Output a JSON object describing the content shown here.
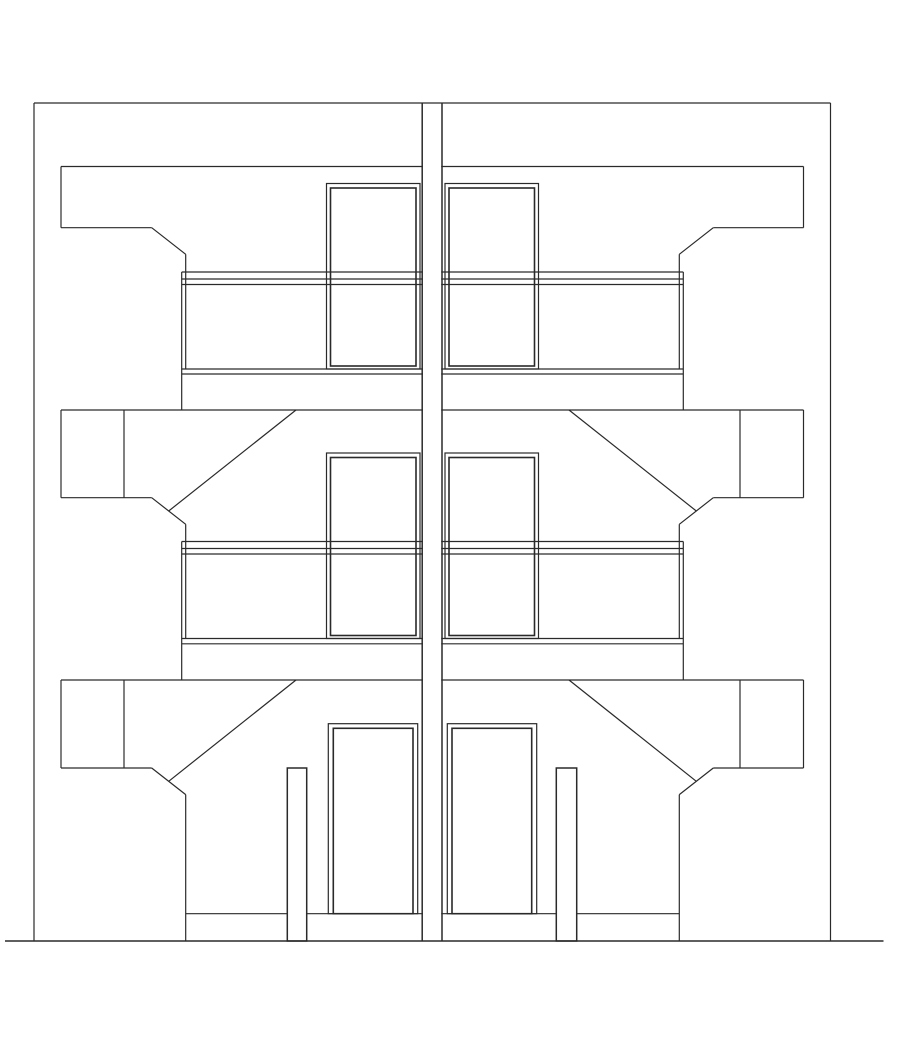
{
  "meta": {
    "canvas": {
      "width": 905,
      "height": 1047
    },
    "background_color": "#ffffff",
    "line_color": "#2a2a2a",
    "default_stroke_width": 1.2
  },
  "drawing": {
    "kind": "building-elevation-line-drawing",
    "layers": [
      {
        "name": "slabs",
        "primitives": [
          {
            "t": "l",
            "n": "roof-slab-top",
            "x1": 61,
            "y1": 166.5,
            "x2": 803.5,
            "y2": 166.5
          },
          {
            "t": "l",
            "n": "roof-slab-left-edge",
            "x1": 61,
            "y1": 166.5,
            "x2": 61,
            "y2": 227.7
          },
          {
            "t": "l",
            "n": "roof-slab-right-edge",
            "x1": 803.5,
            "y1": 166.5,
            "x2": 803.5,
            "y2": 227.7
          },
          {
            "t": "l",
            "n": "roof-slab-bottom-left",
            "x1": 61,
            "y1": 227.7,
            "x2": 151.7,
            "y2": 227.7
          },
          {
            "t": "l",
            "n": "roof-slab-bottom-right",
            "x1": 713.3,
            "y1": 227.7,
            "x2": 803.5,
            "y2": 227.7
          },
          {
            "t": "l",
            "n": "roof-slab-chamfer-left",
            "x1": 151.7,
            "y1": 227.7,
            "x2": 185.7,
            "y2": 254.3
          },
          {
            "t": "l",
            "n": "roof-slab-chamfer-right",
            "x1": 713.3,
            "y1": 227.7,
            "x2": 679.3,
            "y2": 254.3
          },
          {
            "t": "l",
            "n": "mid-slab-top",
            "x1": 61,
            "y1": 410,
            "x2": 803.5,
            "y2": 410
          },
          {
            "t": "l",
            "n": "mid-slab-left-edge",
            "x1": 61,
            "y1": 410,
            "x2": 61,
            "y2": 497.7
          },
          {
            "t": "l",
            "n": "mid-slab-right-edge",
            "x1": 803.5,
            "y1": 410,
            "x2": 803.5,
            "y2": 497.7
          },
          {
            "t": "l",
            "n": "mid-slab-bottom-left",
            "x1": 61,
            "y1": 497.7,
            "x2": 151.7,
            "y2": 497.7
          },
          {
            "t": "l",
            "n": "mid-slab-bottom-right",
            "x1": 713.3,
            "y1": 497.7,
            "x2": 803.5,
            "y2": 497.7
          },
          {
            "t": "l",
            "n": "mid-slab-chamfer-left",
            "x1": 151.7,
            "y1": 497.7,
            "x2": 185.7,
            "y2": 524.3
          },
          {
            "t": "l",
            "n": "mid-slab-chamfer-right",
            "x1": 713.3,
            "y1": 497.7,
            "x2": 679.3,
            "y2": 524.3
          },
          {
            "t": "l",
            "n": "mid-slab-divider-left",
            "x1": 124,
            "y1": 410,
            "x2": 124,
            "y2": 497.7
          },
          {
            "t": "l",
            "n": "mid-slab-divider-right",
            "x1": 740,
            "y1": 410,
            "x2": 740,
            "y2": 497.7
          },
          {
            "t": "l",
            "n": "mid-canopy-diagonal-left",
            "x1": 296,
            "y1": 410,
            "x2": 168.7,
            "y2": 511
          },
          {
            "t": "l",
            "n": "mid-canopy-diagonal-right",
            "x1": 569,
            "y1": 410,
            "x2": 696.3,
            "y2": 511
          },
          {
            "t": "l",
            "n": "ground-slab-top",
            "x1": 61,
            "y1": 680,
            "x2": 803.5,
            "y2": 680
          },
          {
            "t": "l",
            "n": "ground-slab-left-edge",
            "x1": 61,
            "y1": 680,
            "x2": 61,
            "y2": 768
          },
          {
            "t": "l",
            "n": "ground-slab-right-edge",
            "x1": 803.5,
            "y1": 680,
            "x2": 803.5,
            "y2": 768
          },
          {
            "t": "l",
            "n": "ground-slab-bottom-left",
            "x1": 61,
            "y1": 768,
            "x2": 151.7,
            "y2": 768
          },
          {
            "t": "l",
            "n": "ground-slab-bottom-right",
            "x1": 713.3,
            "y1": 768,
            "x2": 803.5,
            "y2": 768
          },
          {
            "t": "l",
            "n": "ground-slab-chamfer-left",
            "x1": 151.7,
            "y1": 768,
            "x2": 185.7,
            "y2": 794.6
          },
          {
            "t": "l",
            "n": "ground-slab-chamfer-right",
            "x1": 713.3,
            "y1": 768,
            "x2": 679.3,
            "y2": 794.6
          },
          {
            "t": "l",
            "n": "ground-slab-divider-left",
            "x1": 124,
            "y1": 680,
            "x2": 124,
            "y2": 768
          },
          {
            "t": "l",
            "n": "ground-slab-divider-right",
            "x1": 740,
            "y1": 680,
            "x2": 740,
            "y2": 768
          },
          {
            "t": "l",
            "n": "ground-canopy-diagonal-left",
            "x1": 296,
            "y1": 680,
            "x2": 168.7,
            "y2": 781.3
          },
          {
            "t": "l",
            "n": "ground-canopy-diagonal-right",
            "x1": 569,
            "y1": 680,
            "x2": 696.3,
            "y2": 781.3
          }
        ]
      },
      {
        "name": "windows",
        "primitives": [
          {
            "t": "r",
            "n": "upper-window-left-opening",
            "x": 326.5,
            "y": 183.5,
            "w": 93.5,
            "h": 185.5
          },
          {
            "t": "r",
            "n": "upper-window-left-frame",
            "x": 330.5,
            "y": 188,
            "w": 85.5,
            "h": 178,
            "sw": 1.6
          },
          {
            "t": "r",
            "n": "upper-window-right-opening",
            "x": 445,
            "y": 183.5,
            "w": 93.5,
            "h": 185.5
          },
          {
            "t": "r",
            "n": "upper-window-right-frame",
            "x": 449,
            "y": 188,
            "w": 85.5,
            "h": 178,
            "sw": 1.6
          },
          {
            "t": "r",
            "n": "mid-window-left-opening",
            "x": 326.5,
            "y": 453,
            "w": 93.5,
            "h": 185.5
          },
          {
            "t": "r",
            "n": "mid-window-left-frame",
            "x": 330.5,
            "y": 457.5,
            "w": 85.5,
            "h": 178,
            "sw": 1.6
          },
          {
            "t": "r",
            "n": "mid-window-right-opening",
            "x": 445,
            "y": 453,
            "w": 93.5,
            "h": 185.5
          },
          {
            "t": "r",
            "n": "mid-window-right-frame",
            "x": 449,
            "y": 457.5,
            "w": 85.5,
            "h": 178,
            "sw": 1.6
          }
        ]
      },
      {
        "name": "balconies",
        "primitives": [
          {
            "t": "l",
            "n": "upper-balcony-inner-left",
            "x1": 185.7,
            "y1": 254.3,
            "x2": 185.7,
            "y2": 369
          },
          {
            "t": "l",
            "n": "upper-balcony-inner-right",
            "x1": 679.3,
            "y1": 254.3,
            "x2": 679.3,
            "y2": 369
          },
          {
            "t": "l",
            "n": "upper-balcony-outer-left",
            "x1": 181.7,
            "y1": 272,
            "x2": 181.7,
            "y2": 410
          },
          {
            "t": "l",
            "n": "upper-balcony-outer-right",
            "x1": 683.3,
            "y1": 272,
            "x2": 683.3,
            "y2": 410
          },
          {
            "t": "l",
            "n": "upper-balcony-rail-top",
            "x1": 181.7,
            "y1": 272,
            "x2": 683.3,
            "y2": 272
          },
          {
            "t": "l",
            "n": "upper-balcony-rail-bottom",
            "x1": 181.7,
            "y1": 279,
            "x2": 683.3,
            "y2": 279
          },
          {
            "t": "l",
            "n": "upper-balcony-panel-top",
            "x1": 181.7,
            "y1": 284.5,
            "x2": 683.3,
            "y2": 284.5
          },
          {
            "t": "l",
            "n": "upper-balcony-floor",
            "x1": 181.7,
            "y1": 369,
            "x2": 683.3,
            "y2": 369
          },
          {
            "t": "l",
            "n": "upper-balcony-soffit",
            "x1": 181.7,
            "y1": 374,
            "x2": 683.3,
            "y2": 374
          },
          {
            "t": "l",
            "n": "mid-balcony-inner-left",
            "x1": 185.7,
            "y1": 524.3,
            "x2": 185.7,
            "y2": 638.5
          },
          {
            "t": "l",
            "n": "mid-balcony-inner-right",
            "x1": 679.3,
            "y1": 524.3,
            "x2": 679.3,
            "y2": 638.5
          },
          {
            "t": "l",
            "n": "mid-balcony-outer-left",
            "x1": 181.7,
            "y1": 541.5,
            "x2": 181.7,
            "y2": 680
          },
          {
            "t": "l",
            "n": "mid-balcony-outer-right",
            "x1": 683.3,
            "y1": 541.5,
            "x2": 683.3,
            "y2": 680
          },
          {
            "t": "l",
            "n": "mid-balcony-rail-top",
            "x1": 181.7,
            "y1": 541.5,
            "x2": 683.3,
            "y2": 541.5
          },
          {
            "t": "l",
            "n": "mid-balcony-rail-bottom",
            "x1": 181.7,
            "y1": 548.5,
            "x2": 683.3,
            "y2": 548.5
          },
          {
            "t": "l",
            "n": "mid-balcony-panel-top",
            "x1": 181.7,
            "y1": 554,
            "x2": 683.3,
            "y2": 554
          },
          {
            "t": "l",
            "n": "mid-balcony-floor",
            "x1": 181.7,
            "y1": 638.5,
            "x2": 683.3,
            "y2": 638.5
          },
          {
            "t": "l",
            "n": "mid-balcony-soffit",
            "x1": 181.7,
            "y1": 643.8,
            "x2": 683.3,
            "y2": 643.8
          }
        ]
      },
      {
        "name": "ground-floor",
        "primitives": [
          {
            "t": "l",
            "n": "porch-wall-left",
            "x1": 185.7,
            "y1": 794.6,
            "x2": 185.7,
            "y2": 941
          },
          {
            "t": "l",
            "n": "porch-wall-right",
            "x1": 679.3,
            "y1": 794.6,
            "x2": 679.3,
            "y2": 941
          },
          {
            "t": "l",
            "n": "porch-floor-line",
            "x1": 185.7,
            "y1": 913.7,
            "x2": 679.3,
            "y2": 913.7
          },
          {
            "t": "r",
            "n": "door-left-opening",
            "x": 328.3,
            "y": 723.7,
            "w": 89.4,
            "h": 190
          },
          {
            "t": "r",
            "n": "door-left-frame",
            "x": 333.3,
            "y": 728.3,
            "w": 79.7,
            "h": 185.4,
            "sw": 1.6
          },
          {
            "t": "r",
            "n": "door-right-opening",
            "x": 447.3,
            "y": 723.7,
            "w": 89.4,
            "h": 190
          },
          {
            "t": "r",
            "n": "door-right-frame",
            "x": 452,
            "y": 728.3,
            "w": 79.7,
            "h": 185.4,
            "sw": 1.6
          },
          {
            "t": "r",
            "n": "porch-post-left",
            "x": 287.3,
            "y": 768,
            "w": 19.4,
            "h": 173,
            "f": "#ffffff",
            "sw": 1.5
          },
          {
            "t": "r",
            "n": "porch-post-right",
            "x": 556.3,
            "y": 768,
            "w": 20.4,
            "h": 173,
            "f": "#ffffff",
            "sw": 1.5
          }
        ]
      },
      {
        "name": "party-wall",
        "primitives": [
          {
            "t": "r",
            "n": "party-wall-fill",
            "x": 423,
            "y": 103.6,
            "w": 18.2,
            "h": 836.4,
            "f": "#ffffff",
            "sw": 0
          },
          {
            "t": "l",
            "n": "party-wall-left-edge",
            "x1": 422.2,
            "y1": 103,
            "x2": 422.2,
            "y2": 941,
            "sw": 1.5
          },
          {
            "t": "l",
            "n": "party-wall-right-edge",
            "x1": 442,
            "y1": 103,
            "x2": 442,
            "y2": 941,
            "sw": 1.5
          }
        ]
      },
      {
        "name": "building-shell",
        "primitives": [
          {
            "t": "l",
            "n": "building-top-edge",
            "x1": 34,
            "y1": 103,
            "x2": 830.5,
            "y2": 103
          },
          {
            "t": "l",
            "n": "building-left-edge",
            "x1": 34,
            "y1": 103,
            "x2": 34,
            "y2": 941
          },
          {
            "t": "l",
            "n": "building-right-edge",
            "x1": 830.5,
            "y1": 103,
            "x2": 830.5,
            "y2": 941
          },
          {
            "t": "l",
            "n": "ground-line",
            "x1": 5,
            "y1": 941,
            "x2": 883.5,
            "y2": 941,
            "sw": 1.5
          }
        ]
      }
    ]
  }
}
